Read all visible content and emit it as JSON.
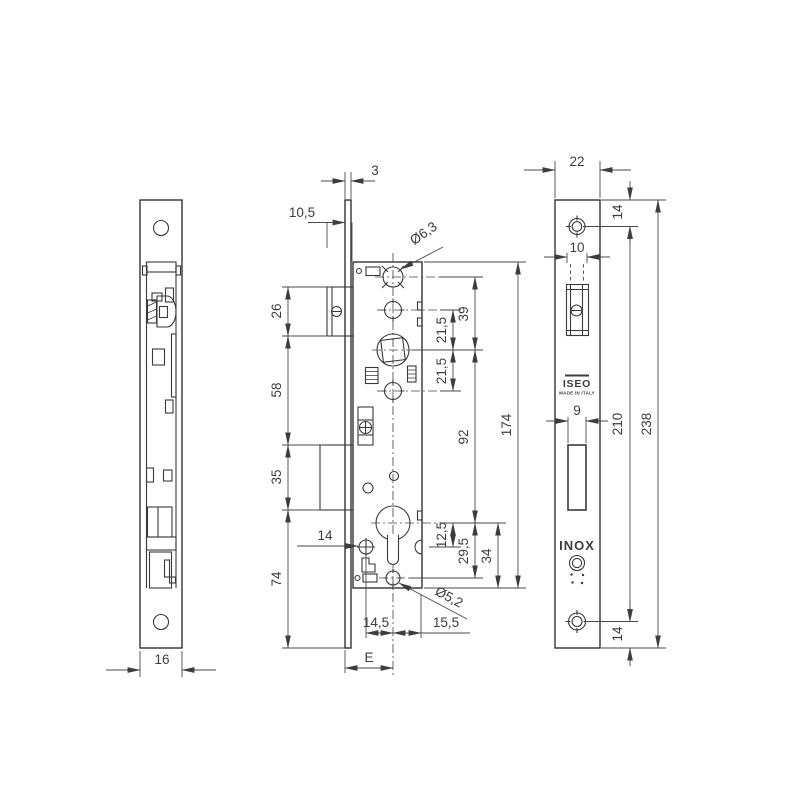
{
  "drawing": {
    "dims": {
      "side_width": "16",
      "plate_thickness": "3",
      "latch_projection": "10,5",
      "latch_height": "26",
      "latch_to_bolt": "58",
      "bolt_height": "35",
      "bolt_to_bottom": "74",
      "top_hole_dia": "Ø6,3",
      "hole_to_follower": "39",
      "follower_up": "21,5",
      "follower_down": "21,5",
      "follower_to_cylinder": "92",
      "case_height": "174",
      "cylinder_to_notch": "12,5",
      "cylinder_to_screw": "29,5",
      "cylinder_to_case_bottom": "34",
      "screw_inset": "14",
      "bottom_hole_dia": "Ø5,2",
      "screw_to_axis": "14,5",
      "axis_to_edge": "15,5",
      "backset": "E",
      "plate_width": "22",
      "top_screw_offset": "14",
      "latch_cutout": "10",
      "bolt_cutout": "9",
      "screw_spacing": "210",
      "plate_height": "238",
      "bottom_screw_offset": "14"
    },
    "texts": {
      "brand": "ISEO",
      "made_in": "MADE IN ITALY",
      "material": "INOX"
    }
  }
}
